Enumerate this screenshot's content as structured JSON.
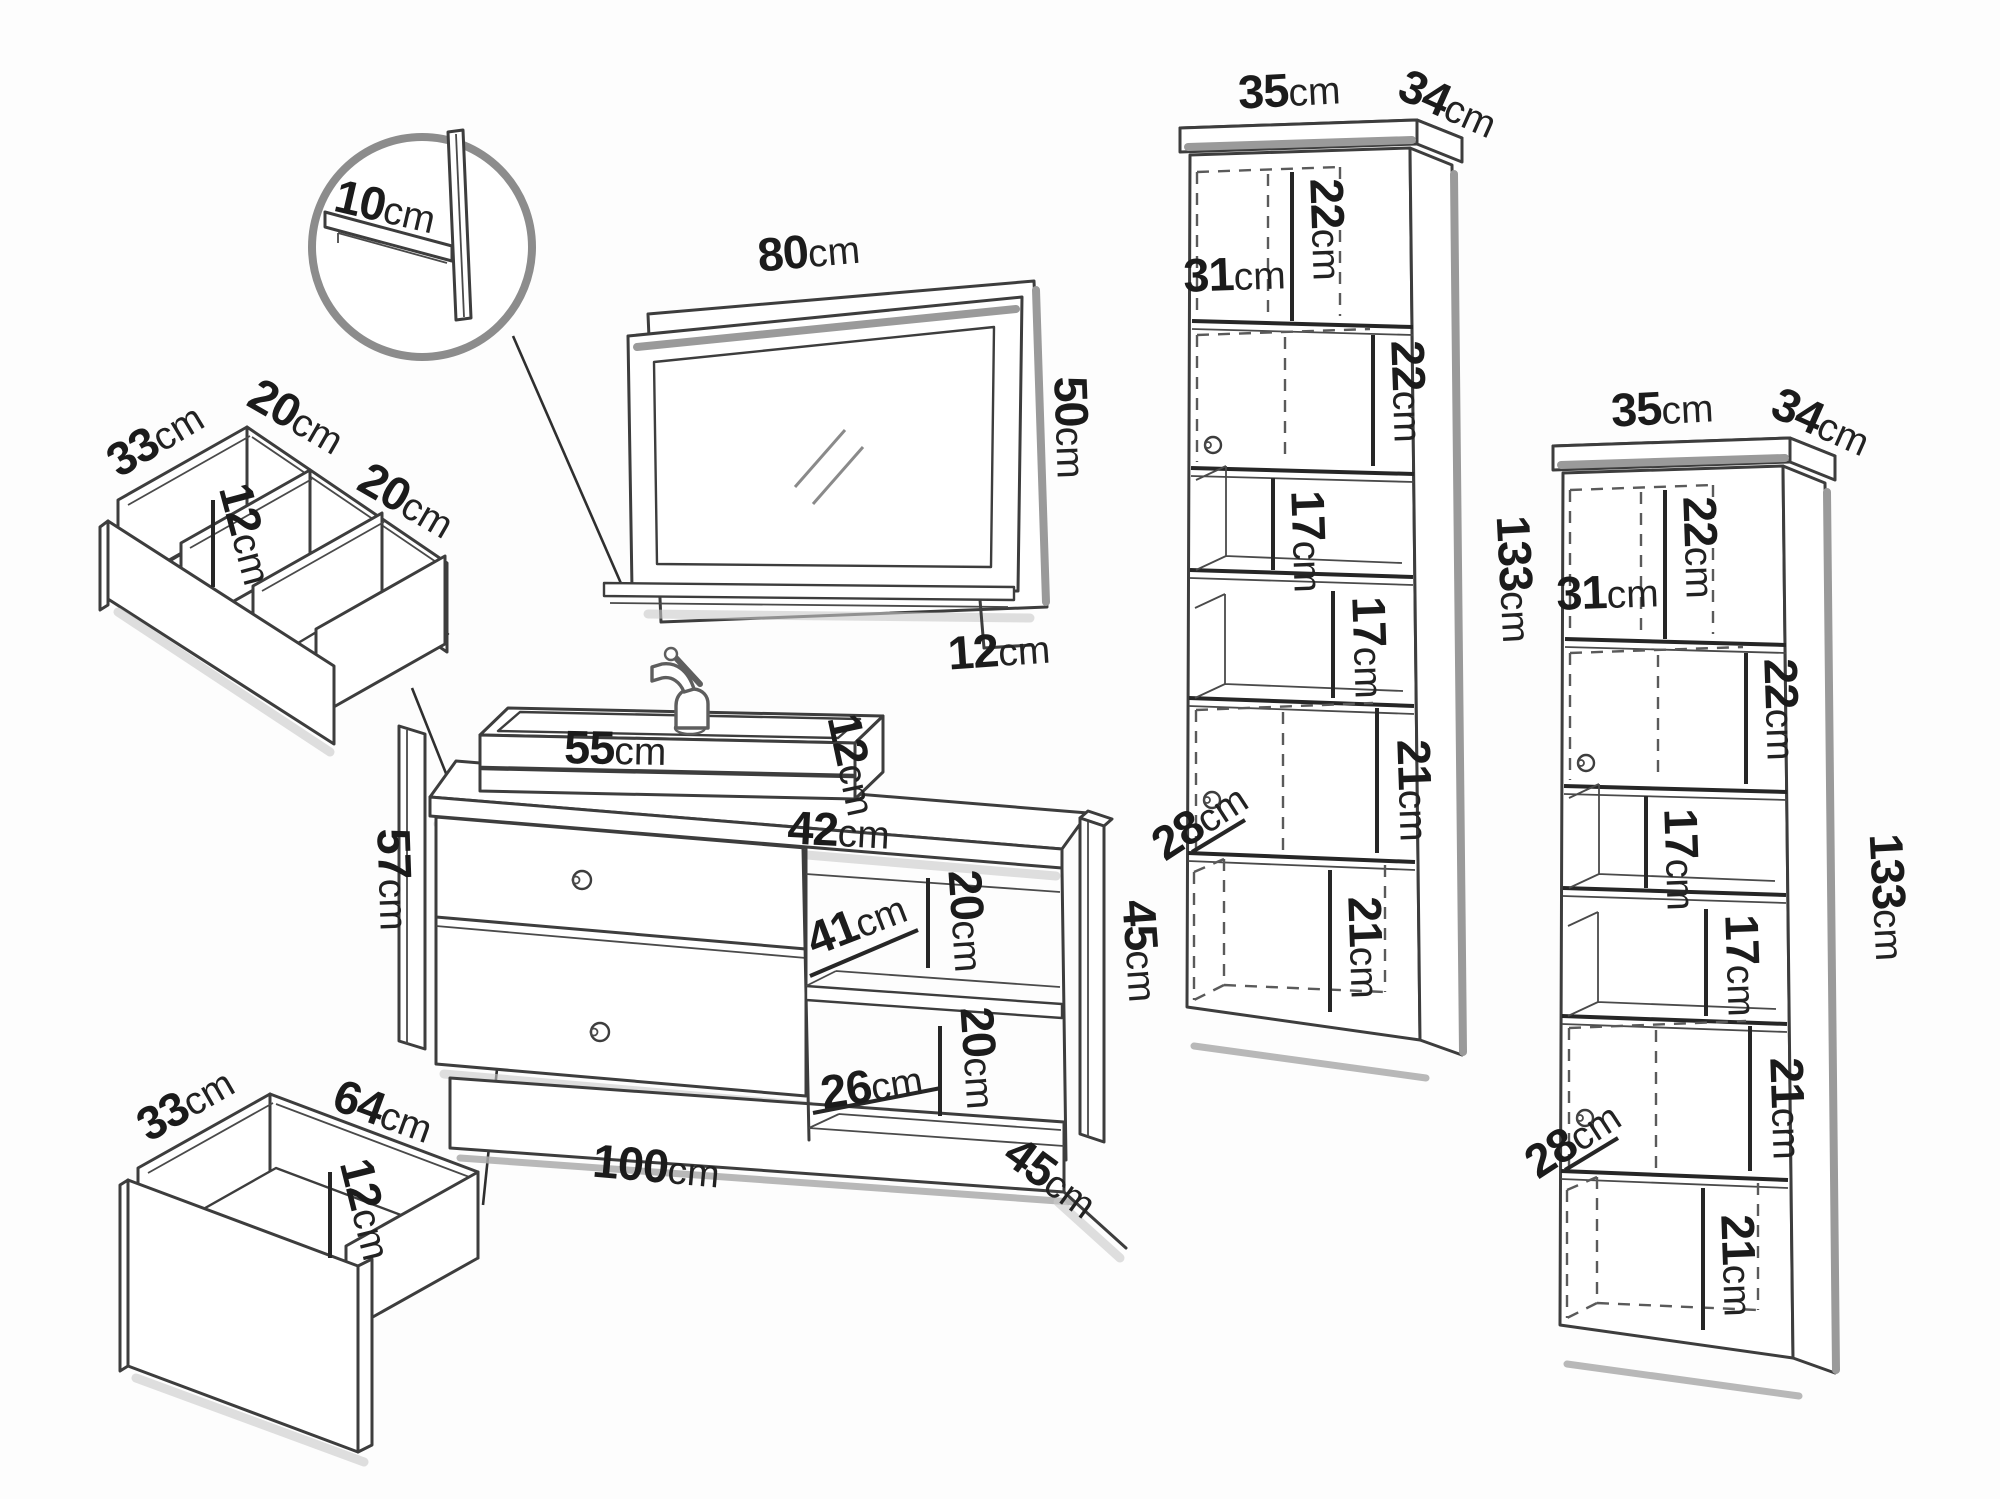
{
  "diagram": {
    "type": "furniture-dimension-line-drawing",
    "background": "#fdfdfd",
    "line_color": "#3d3d3d",
    "shadow_color": "#a9a9a9",
    "text_color": "#1b1b1b"
  },
  "detail_view": {
    "shelf_depth": {
      "v": "10",
      "u": "cm"
    }
  },
  "mirror": {
    "width": {
      "v": "80",
      "u": "cm"
    },
    "height": {
      "v": "50",
      "u": "cm"
    },
    "shelf_depth": {
      "v": "12",
      "u": "cm"
    }
  },
  "siphon_drawer": {
    "depth": {
      "v": "33",
      "u": "cm"
    },
    "left_compartment_width": {
      "v": "20",
      "u": "cm"
    },
    "wall_height": {
      "v": "12",
      "u": "cm"
    },
    "right_compartment_width": {
      "v": "20",
      "u": "cm"
    }
  },
  "lower_drawer": {
    "depth": {
      "v": "33",
      "u": "cm"
    },
    "width": {
      "v": "64",
      "u": "cm"
    },
    "wall_height": {
      "v": "12",
      "u": "cm"
    }
  },
  "vanity": {
    "basin_width": {
      "v": "55",
      "u": "cm"
    },
    "basin_height": {
      "v": "12",
      "u": "cm"
    },
    "countertop_depth": {
      "v": "42",
      "u": "cm"
    },
    "left_panel_height": {
      "v": "57",
      "u": "cm"
    },
    "niche_upper_height": {
      "v": "20",
      "u": "cm"
    },
    "niche_depth": {
      "v": "41",
      "u": "cm"
    },
    "niche_lower_height": {
      "v": "20",
      "u": "cm"
    },
    "niche_lower_width": {
      "v": "26",
      "u": "cm"
    },
    "width": {
      "v": "100",
      "u": "cm"
    },
    "depth": {
      "v": "45",
      "u": "cm"
    },
    "side_panel_height": {
      "v": "45",
      "u": "cm"
    }
  },
  "tall_cabinet_left": {
    "width": {
      "v": "35",
      "u": "cm"
    },
    "depth": {
      "v": "34",
      "u": "cm"
    },
    "top_door_height": {
      "v": "22",
      "u": "cm"
    },
    "top_door_width": {
      "v": "31",
      "u": "cm"
    },
    "second_door_height": {
      "v": "22",
      "u": "cm"
    },
    "upper_shelf_height": {
      "v": "17",
      "u": "cm"
    },
    "lower_shelf_height": {
      "v": "17",
      "u": "cm"
    },
    "third_door_height": {
      "v": "21",
      "u": "cm"
    },
    "door_depth": {
      "v": "28",
      "u": "cm"
    },
    "bottom_door_height": {
      "v": "21",
      "u": "cm"
    },
    "total_height": {
      "v": "133",
      "u": "cm"
    }
  },
  "tall_cabinet_right": {
    "width": {
      "v": "35",
      "u": "cm"
    },
    "depth": {
      "v": "34",
      "u": "cm"
    },
    "top_door_height": {
      "v": "22",
      "u": "cm"
    },
    "top_door_width": {
      "v": "31",
      "u": "cm"
    },
    "second_door_height": {
      "v": "22",
      "u": "cm"
    },
    "upper_shelf_height": {
      "v": "17",
      "u": "cm"
    },
    "lower_shelf_height": {
      "v": "17",
      "u": "cm"
    },
    "third_door_height": {
      "v": "21",
      "u": "cm"
    },
    "door_depth": {
      "v": "28",
      "u": "cm"
    },
    "bottom_door_height": {
      "v": "21",
      "u": "cm"
    },
    "total_height": {
      "v": "133",
      "u": "cm"
    }
  }
}
